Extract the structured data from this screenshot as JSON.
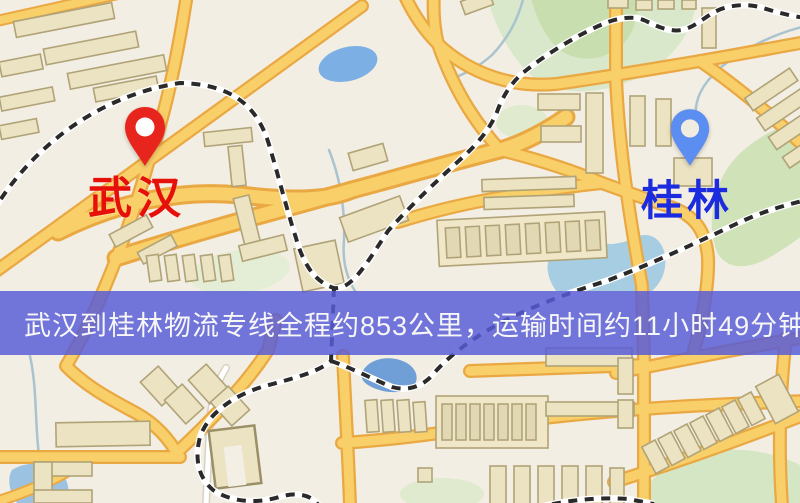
{
  "map": {
    "origin_marker": {
      "icon": "map-pin-icon",
      "label": "武汉",
      "label_color": "#e60f0a",
      "pin_color": "#e8251d"
    },
    "destination_marker": {
      "icon": "map-pin-icon",
      "label": "桂林",
      "label_color": "#1c2bdd",
      "pin_color": "#5c8df0"
    },
    "info_banner": {
      "text": "武汉到桂林物流专线全程约853公里，运输时间约11小时49分钟.",
      "route_from": "武汉",
      "route_to": "桂林",
      "distance_km": 853,
      "duration_hours": 11,
      "duration_minutes": 49,
      "background_color": "#585cd6",
      "text_color": "#f7f7f7"
    },
    "legend_colors": {
      "road_major": "#f8cf68",
      "road_casing": "#eaa843",
      "building": "#ece3c3",
      "water": "#7cb0e4",
      "park": "#cfe2b8",
      "railway": "#2a2a2a",
      "background": "#f3eee3"
    }
  }
}
